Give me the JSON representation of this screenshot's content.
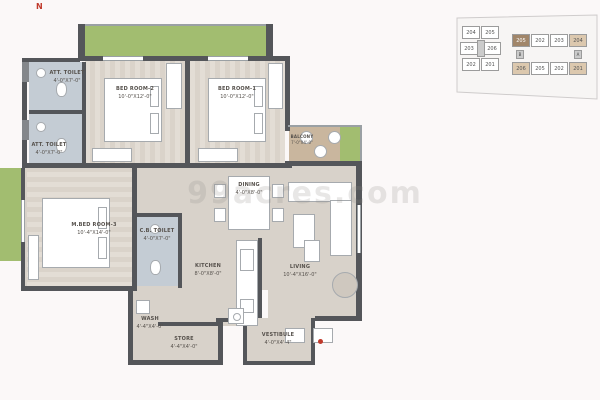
{
  "north": "N",
  "watermark": "99acres.com",
  "colors": {
    "wall": "#54565a",
    "floor": "#d8d2ca",
    "bedroom_floor": "#e3ddd5",
    "toilet_floor": "#c4ccd4",
    "green_area": "#a2bd70",
    "balcony": "#c9b69e",
    "accent_red": "#c0392b",
    "keyplan_highlight_dark": "#a1866a",
    "keyplan_highlight_tan": "#dcc8ae"
  },
  "rooms": {
    "bedroom2": {
      "name": "BED ROOM-2",
      "dims": "10'-0\"X12'-0\""
    },
    "bedroom1": {
      "name": "BED ROOM-1",
      "dims": "10'-0\"X12'-0\""
    },
    "att_toilet_top": {
      "name": "ATT. TOILET",
      "dims": "4'-0\"X7'-0\""
    },
    "att_toilet_bot": {
      "name": "ATT. TOILET",
      "dims": "4'-0\"X7'-0\""
    },
    "m_bedroom3": {
      "name": "M.BED ROOM-3",
      "dims": "10'-4\"X14'-0\""
    },
    "cb_toilet": {
      "name": "C.B. TOILET",
      "dims": "4'-0\"X7'-0\""
    },
    "dining": {
      "name": "DINING",
      "dims": "4'-0\"X8'-0\""
    },
    "kitchen": {
      "name": "KITCHEN",
      "dims": "8'-0\"X8'-0\""
    },
    "living": {
      "name": "LIVING",
      "dims": "10'-4\"X16'-0\""
    },
    "balcony": {
      "name": "BALCONY",
      "dims": "7'-0\"X4'-0\""
    },
    "wash": {
      "name": "WASH",
      "dims": "4'-4\"X4'-0\""
    },
    "store": {
      "name": "STORE",
      "dims": "4'-4\"X4'-0\""
    },
    "vestibule": {
      "name": "VESTIBULE",
      "dims": "4'-0\"X4'-4\""
    }
  },
  "keyplan": {
    "left_block": [
      "204",
      "205",
      "203",
      "206",
      "202",
      "201"
    ],
    "right_top": [
      "205",
      "202",
      "203",
      "204"
    ],
    "right_bottom": [
      "206",
      "205",
      "202",
      "201"
    ],
    "cores": [
      "B",
      "A"
    ]
  }
}
